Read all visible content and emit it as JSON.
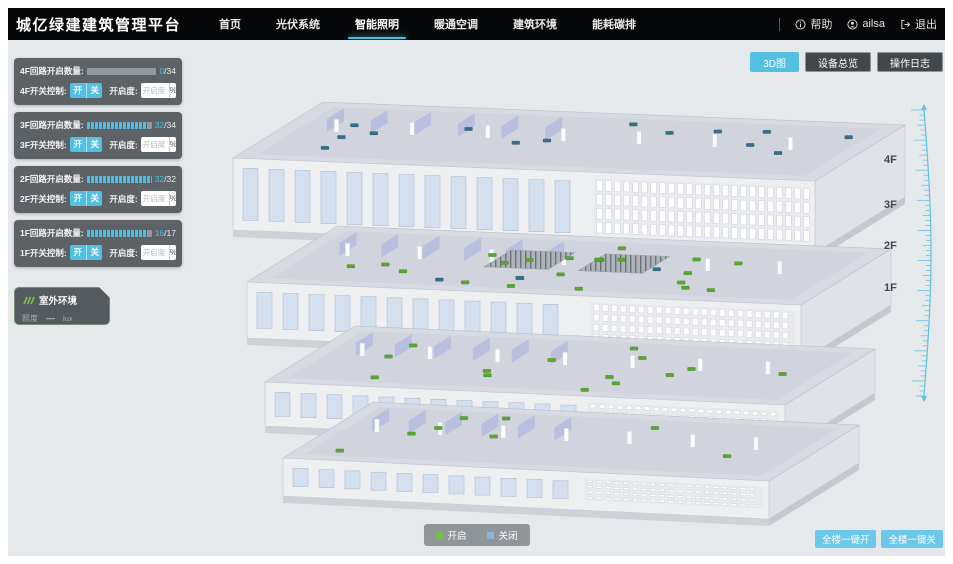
{
  "header": {
    "title": "城亿绿建建筑管理平台",
    "nav": [
      {
        "label": "首页",
        "active": false
      },
      {
        "label": "光伏系统",
        "active": false
      },
      {
        "label": "智能照明",
        "active": true
      },
      {
        "label": "暖通空调",
        "active": false
      },
      {
        "label": "建筑环境",
        "active": false
      },
      {
        "label": "能耗碳排",
        "active": false
      }
    ],
    "help_label": "帮助",
    "user_name": "ailsa",
    "logout_label": "退出"
  },
  "toolbar": {
    "buttons": [
      {
        "label": "3D图",
        "active": true
      },
      {
        "label": "设备总览",
        "active": false
      },
      {
        "label": "操作日志",
        "active": false
      }
    ]
  },
  "floor_panels": [
    {
      "floor": "4F",
      "circuit_label": "4F回路开启数量:",
      "open": 0,
      "total": 34,
      "value_open": "0",
      "value_total": "/34",
      "switch_label": "4F开关控制:",
      "btn_on": "开",
      "btn_off": "关",
      "dim_label": "开启度:",
      "dim_placeholder": "开启度",
      "percent_label": "%"
    },
    {
      "floor": "3F",
      "circuit_label": "3F回路开启数量:",
      "open": 32,
      "total": 34,
      "value_open": "32",
      "value_total": "/34",
      "switch_label": "3F开关控制:",
      "btn_on": "开",
      "btn_off": "关",
      "dim_label": "开启度:",
      "dim_placeholder": "开启度",
      "percent_label": "%"
    },
    {
      "floor": "2F",
      "circuit_label": "2F回路开启数量:",
      "open": 32,
      "total": 32,
      "value_open": "32",
      "value_total": "/32",
      "switch_label": "2F开关控制:",
      "btn_on": "开",
      "btn_off": "关",
      "dim_label": "开启度:",
      "dim_placeholder": "开启度",
      "percent_label": "%"
    },
    {
      "floor": "1F",
      "circuit_label": "1F回路开启数量:",
      "open": 16,
      "total": 17,
      "value_open": "16",
      "value_total": "/17",
      "switch_label": "1F开关控制:",
      "btn_on": "开",
      "btn_off": "关",
      "dim_label": "开启度:",
      "dim_placeholder": "开启度",
      "percent_label": "%"
    }
  ],
  "outdoor": {
    "title": "室外环境",
    "metric_label": "照度",
    "value": "—",
    "unit": "lux"
  },
  "floor_markers": [
    "4F",
    "3F",
    "2F",
    "1F"
  ],
  "legend": {
    "items": [
      {
        "label": "开启",
        "color": "#7cb94e"
      },
      {
        "label": "关闭",
        "color": "#8fb4d9"
      }
    ]
  },
  "footer": {
    "all_on": "全楼一键开",
    "all_off": "全楼一键关"
  },
  "building": {
    "floors": [
      {
        "label": "4F",
        "lights_on": 0,
        "lights_off": 14
      },
      {
        "label": "3F",
        "lights_on": 22,
        "lights_off": 3
      },
      {
        "label": "2F",
        "lights_on": 14,
        "lights_off": 0
      },
      {
        "label": "1F",
        "lights_on": 8,
        "lights_off": 0
      }
    ],
    "light_on_color": "#57a82e",
    "light_off_color": "#35708a"
  },
  "colors": {
    "accent": "#4cc0e4",
    "header_bg": "#060708",
    "stage_bg": "#e6e9ec",
    "panel_bg": "#52575c"
  }
}
